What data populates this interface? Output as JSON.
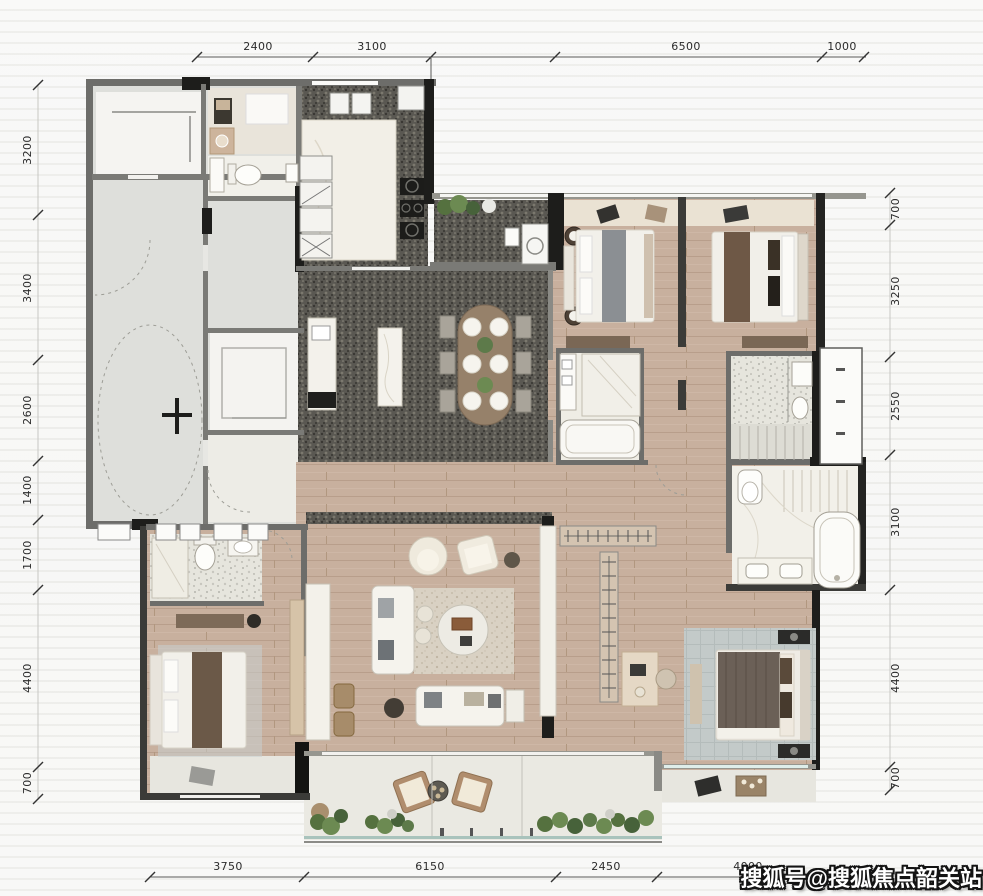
{
  "dimensions": {
    "top": [
      "2400",
      "3100",
      "6500",
      "1000"
    ],
    "left": [
      "3200",
      "3400",
      "2600",
      "1400",
      "1700",
      "4400",
      "700"
    ],
    "right": [
      "700",
      "3250",
      "2550",
      "3100",
      "4400",
      "700"
    ],
    "bottom": [
      "3750",
      "6150",
      "2450",
      "4000"
    ]
  },
  "watermark": {
    "text": "搜狐号@搜狐焦点韶关站"
  },
  "colors": {
    "wall_dark": "#1d1d1b",
    "wall_gray": "#6d6d6a",
    "wood_floor": "#c8b09e",
    "granite_dark": "#5a5852",
    "terrazzo_light": "#e6e5dd",
    "marble_white": "#f2efe8",
    "balcony_tile": "#eae9e2",
    "glass_rail": "#a9c3bc",
    "rug_blue_gray": "#c3cac9",
    "plant_green": "#5d7a4a",
    "table_wood": "#96816a"
  }
}
